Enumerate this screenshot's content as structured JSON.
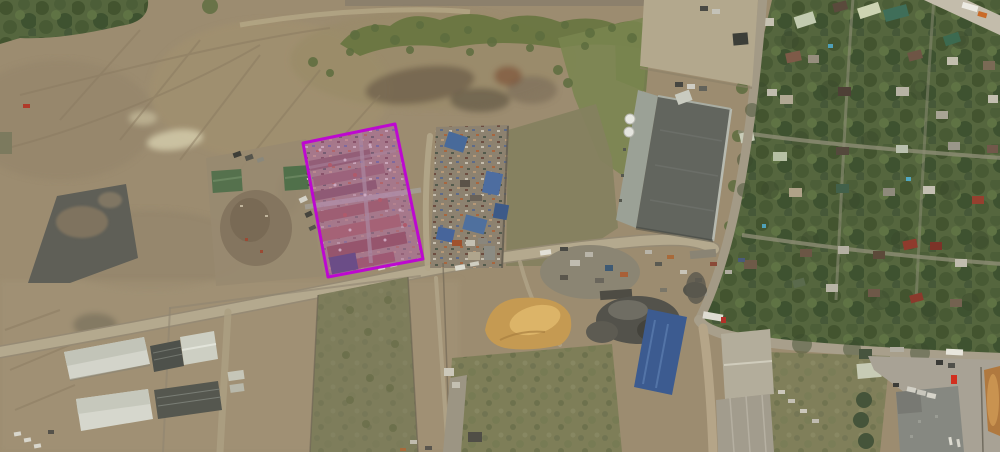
{
  "canvas": {
    "width": 1000,
    "height": 452
  },
  "overlay": {
    "parcel_highlight": {
      "points": "303,143 395,124 423,259 328,277",
      "stroke_color": "#bd08d0",
      "stroke_width": "3",
      "fill_color": "#c968c9",
      "fill_opacity": "0.33"
    }
  },
  "palette": {
    "terrain_dirt": "#9c8c70",
    "terrain_dirt_light": "#a79a7e",
    "asphalt": "#5f5f57",
    "grass": "#79854f",
    "foliage": "#55663e",
    "road": "#b4a98e",
    "warehouse_roof_dark": "#62655e",
    "warehouse_roof_light": "#9ba196",
    "white_roof": "#d3d4ca",
    "blue_roof": "#3c5b90",
    "sand": "#c59a52"
  }
}
